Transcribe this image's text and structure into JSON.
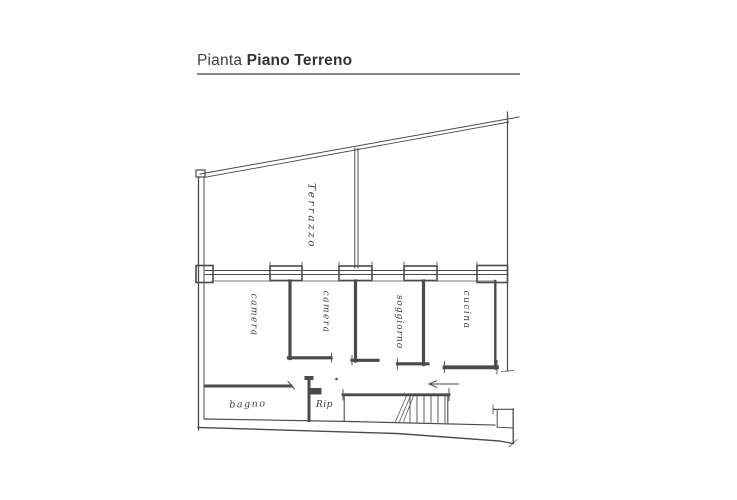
{
  "window": {
    "background": "#ffffff"
  },
  "header": {
    "title_prefix": "Pianta",
    "title_emphasis": "Piano Terreno",
    "text_color": "#3d3d3d",
    "rule_color": "#878787"
  },
  "floor_plan": {
    "type": "architectural-sketch",
    "ink_color": "#4a4a4a",
    "paper_color": "#ffffff",
    "rooms": [
      {
        "id": "terrazzo",
        "label": "Terrazzo",
        "orientation": "vertical"
      },
      {
        "id": "camera-1",
        "label": "camera",
        "orientation": "vertical"
      },
      {
        "id": "camera-2",
        "label": "camera",
        "orientation": "vertical"
      },
      {
        "id": "soggiorno",
        "label": "soggiorno",
        "orientation": "vertical"
      },
      {
        "id": "cucina",
        "label": "cucina",
        "orientation": "vertical"
      },
      {
        "id": "bagno",
        "label": "bagno",
        "orientation": "horizontal"
      },
      {
        "id": "ripostiglio",
        "label": "Rip",
        "orientation": "horizontal"
      }
    ],
    "features": [
      {
        "id": "windows-row",
        "description": "four window openings along top wall of rooms"
      },
      {
        "id": "staircase",
        "description": "stair with hatched treads, bottom right"
      },
      {
        "id": "direction-arrow",
        "description": "arrow pointing left above staircase"
      }
    ]
  }
}
